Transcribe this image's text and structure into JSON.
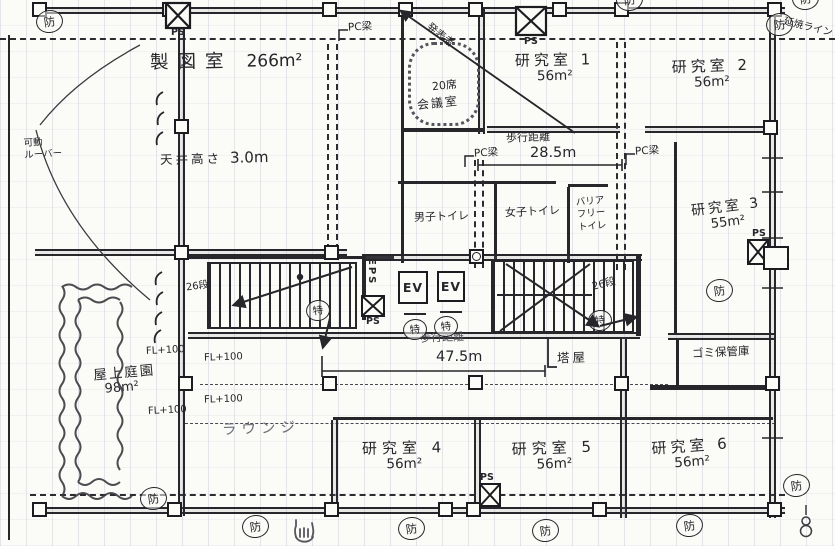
{
  "plan": {
    "rooms": {
      "drafting": {
        "name": "製図室",
        "area": "266m²",
        "ceiling_label": "天井高さ",
        "ceiling_value": "3.0m"
      },
      "meeting": {
        "capacity": "20席",
        "name": "会議室",
        "annotation": "発表者"
      },
      "lab1": {
        "name": "研究室 1",
        "area": "56m²"
      },
      "lab2": {
        "name": "研究室 2",
        "area": "56m²"
      },
      "lab3": {
        "name": "研究室 3",
        "area": "55m²"
      },
      "lab4": {
        "name": "研究室 4",
        "area": "56m²"
      },
      "lab5": {
        "name": "研究室 5",
        "area": "56m²"
      },
      "lab6": {
        "name": "研究室 6",
        "area": "56m²"
      },
      "mens_toilet": {
        "name": "男子トイレ"
      },
      "womens_toilet": {
        "name": "女子トイレ"
      },
      "accessible_toilet": {
        "line1": "バリア",
        "line2": "フリー",
        "line3": "トイレ"
      },
      "roof_garden": {
        "name": "屋上庭園",
        "area": "98m²"
      },
      "lounge": {
        "name": "ラウンジ"
      },
      "garbage": {
        "name": "ゴミ保管庫"
      },
      "penthouse": {
        "name": "塔屋"
      }
    },
    "circulation": {
      "walk_distance_label": "歩行距離",
      "walk_distance_top": "28.5m",
      "walk_distance_main": "47.5m",
      "stair_steps": "26段",
      "elevator_label": "EV"
    },
    "annotations": {
      "floor_level": "FL+100",
      "pipe_shaft": "PS",
      "electrical_shaft": "EPS",
      "pc_beam": "PC梁",
      "fire_shutter_mark": "防",
      "fire_door_mark": "特",
      "fire_spread_line": "延焼ライン",
      "louver_line1": "可動",
      "louver_line2": "ルーバー"
    },
    "colors": {
      "ink": "#26262b",
      "paper": "#fbfbf7",
      "pencil": "#6a6d76"
    }
  }
}
